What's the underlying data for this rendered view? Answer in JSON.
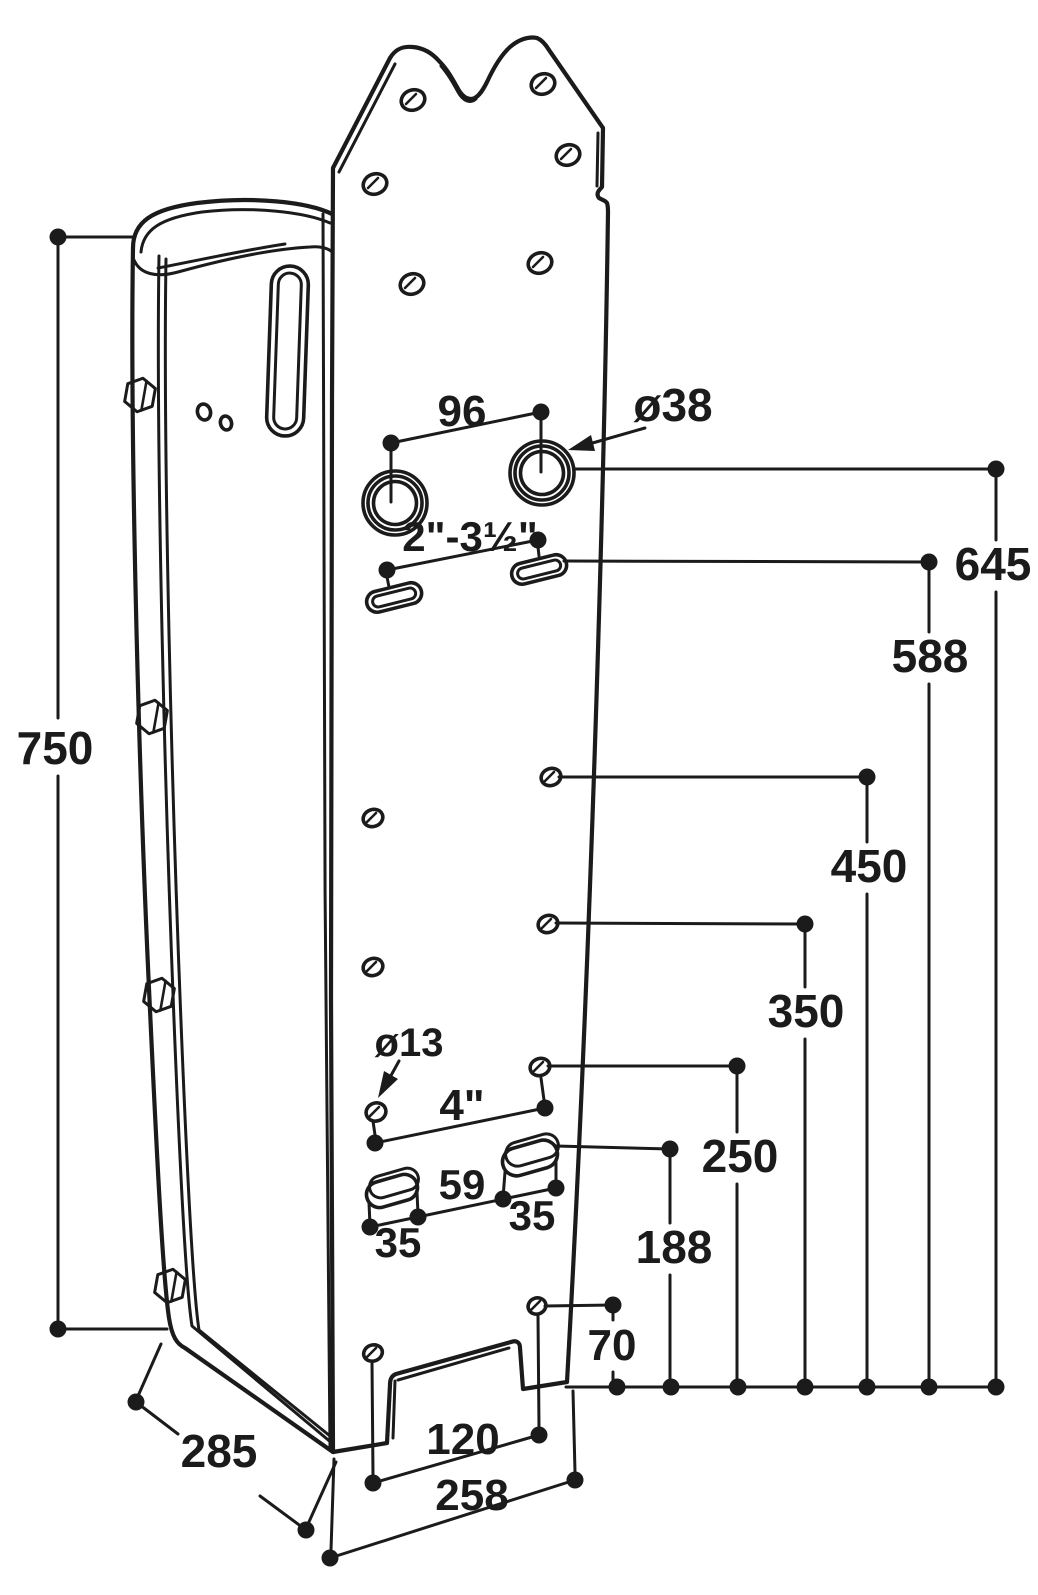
{
  "page": {
    "background": "#ffffff",
    "line_color": "#1b1b1b"
  },
  "drawing": {
    "type": "isometric dimensional drawing of a pole-mount bracket",
    "labels": {
      "overall_height": "750",
      "depth": "285",
      "base_width": "258",
      "bottom_hole_spacing": "120",
      "top_hole_spacing": "96",
      "large_hole_diameter": "ø38",
      "pipe_clamp_range": "2\"-3½\"",
      "height_645": "645",
      "height_588": "588",
      "height_450": "450",
      "height_350": "350",
      "height_250": "250",
      "height_188": "188",
      "height_70": "70",
      "small_hole_diameter": "ø13",
      "hole_spacing_4in": "4\"",
      "strap_slot_gap": "59",
      "strap_slot_left_width": "35",
      "strap_slot_right_width": "35"
    }
  }
}
